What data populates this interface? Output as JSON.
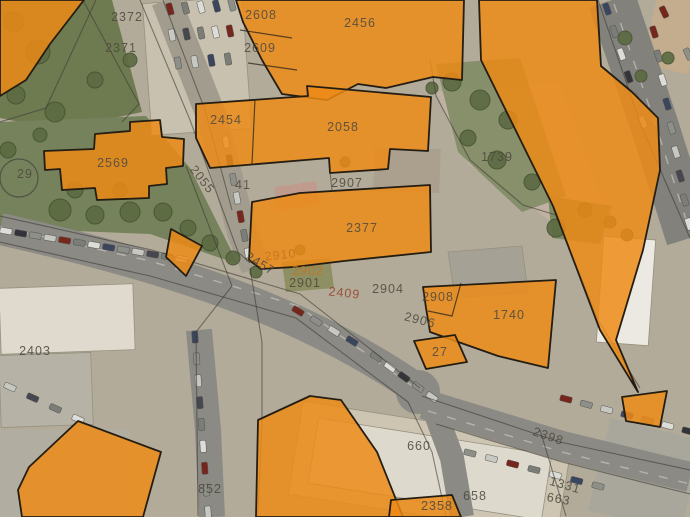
{
  "map": {
    "type": "cadastral-parcel-overlay-on-aerial-imagery",
    "overlay_color": "#ed8a15",
    "label_tones": {
      "default": "#4e4a40",
      "orange": "#c4731a",
      "red": "#96452f"
    },
    "parcel_labels": [
      {
        "text": "2372",
        "x": 127,
        "y": 21
      },
      {
        "text": "2371",
        "x": 121,
        "y": 52
      },
      {
        "text": "2608",
        "x": 261,
        "y": 19
      },
      {
        "text": "2609",
        "x": 260,
        "y": 52
      },
      {
        "text": "2456",
        "x": 360,
        "y": 27
      },
      {
        "text": "2454",
        "x": 226,
        "y": 124
      },
      {
        "text": "2058",
        "x": 343,
        "y": 131
      },
      {
        "text": "1739",
        "x": 497,
        "y": 161
      },
      {
        "text": "2569",
        "x": 113,
        "y": 167
      },
      {
        "text": "29",
        "x": 25,
        "y": 178
      },
      {
        "text": "2055",
        "x": 199,
        "y": 182,
        "rot": 52
      },
      {
        "text": "41",
        "x": 243,
        "y": 189
      },
      {
        "text": "2907",
        "x": 347,
        "y": 187
      },
      {
        "text": "2377",
        "x": 362,
        "y": 232
      },
      {
        "text": "2910",
        "x": 281,
        "y": 259,
        "rot": -6,
        "tone": "orange"
      },
      {
        "text": "2902",
        "x": 308,
        "y": 275,
        "tone": "orange"
      },
      {
        "text": "2901",
        "x": 305,
        "y": 287
      },
      {
        "text": "2457",
        "x": 258,
        "y": 267,
        "rot": 32
      },
      {
        "text": "2409",
        "x": 344,
        "y": 297,
        "rot": 6,
        "tone": "red"
      },
      {
        "text": "2904",
        "x": 388,
        "y": 293
      },
      {
        "text": "2908",
        "x": 438,
        "y": 301
      },
      {
        "text": "2906",
        "x": 419,
        "y": 324,
        "rot": 14
      },
      {
        "text": "1740",
        "x": 509,
        "y": 319
      },
      {
        "text": "27",
        "x": 440,
        "y": 356
      },
      {
        "text": "2403",
        "x": 35,
        "y": 355
      },
      {
        "text": "852",
        "x": 210,
        "y": 493
      },
      {
        "text": "660",
        "x": 419,
        "y": 450
      },
      {
        "text": "2358",
        "x": 437,
        "y": 510
      },
      {
        "text": "658",
        "x": 475,
        "y": 500
      },
      {
        "text": "1331",
        "x": 564,
        "y": 489,
        "rot": 16
      },
      {
        "text": "663",
        "x": 558,
        "y": 503,
        "rot": 10
      },
      {
        "text": "2398",
        "x": 547,
        "y": 440,
        "rot": 19
      }
    ]
  }
}
